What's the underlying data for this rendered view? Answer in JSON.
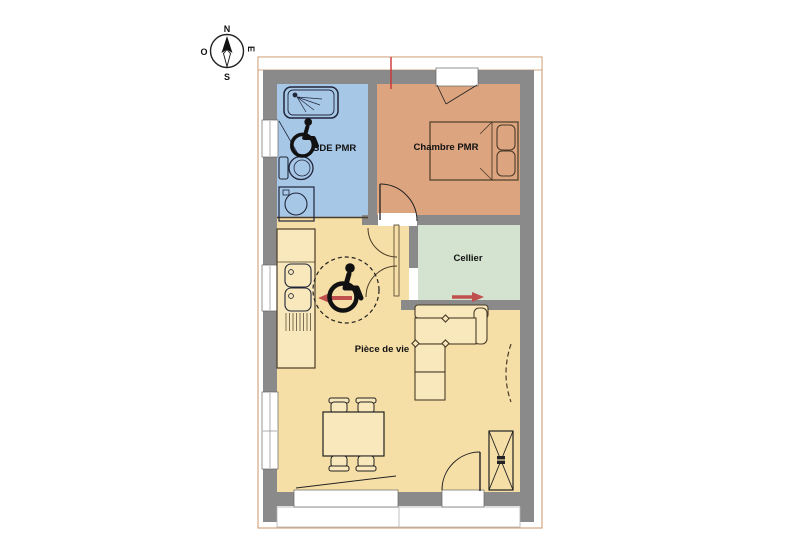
{
  "compass": {
    "north": "N",
    "south": "S",
    "west": "O",
    "east": "E"
  },
  "rooms": {
    "bathroom": {
      "label": "SDE PMR",
      "color": "#a7c7e7"
    },
    "bedroom": {
      "label": "Chambre PMR",
      "color": "#dca47f"
    },
    "cellar": {
      "label": "Cellier",
      "color": "#d3e3cf"
    },
    "living": {
      "label": "Pièce de vie",
      "color": "#f6dfa7"
    }
  },
  "colors": {
    "wall": "#8a8a8a",
    "roof_outline": "#c89368",
    "counter_fill": "#f9e8bc",
    "furniture_stroke": "#4a3c28",
    "fixture_stroke": "#20253a",
    "entrance_arrow": "#c0504d",
    "turning_circle_arrow": "#c0504d",
    "survey_marker": "#cc3333",
    "background": "#ffffff"
  }
}
